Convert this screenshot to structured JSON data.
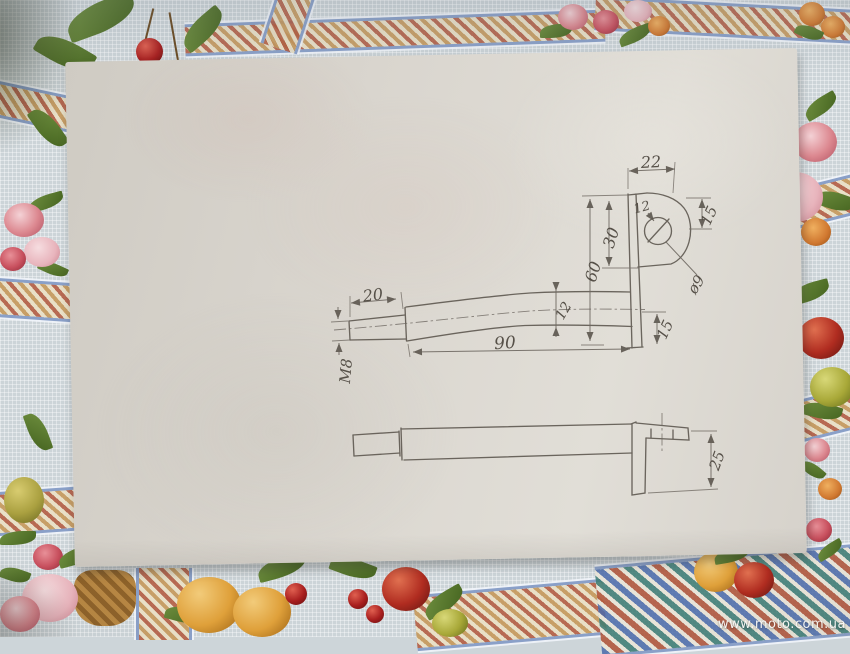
{
  "photo": {
    "watermark": "www.moto.com.ua",
    "scene": "hand-drawn technical sketch on a sheet of paper lying on a patterned tablecloth"
  },
  "drawing": {
    "views": 2,
    "dims": {
      "d22": "22",
      "d15_top": "15",
      "d12_hole": "12",
      "d30": "30",
      "d60": "60",
      "d12_rod": "12",
      "d90": "90",
      "d15_bottom": "15",
      "d20": "20",
      "dM8": "M8",
      "d9": "ø9",
      "d25": "25"
    }
  }
}
